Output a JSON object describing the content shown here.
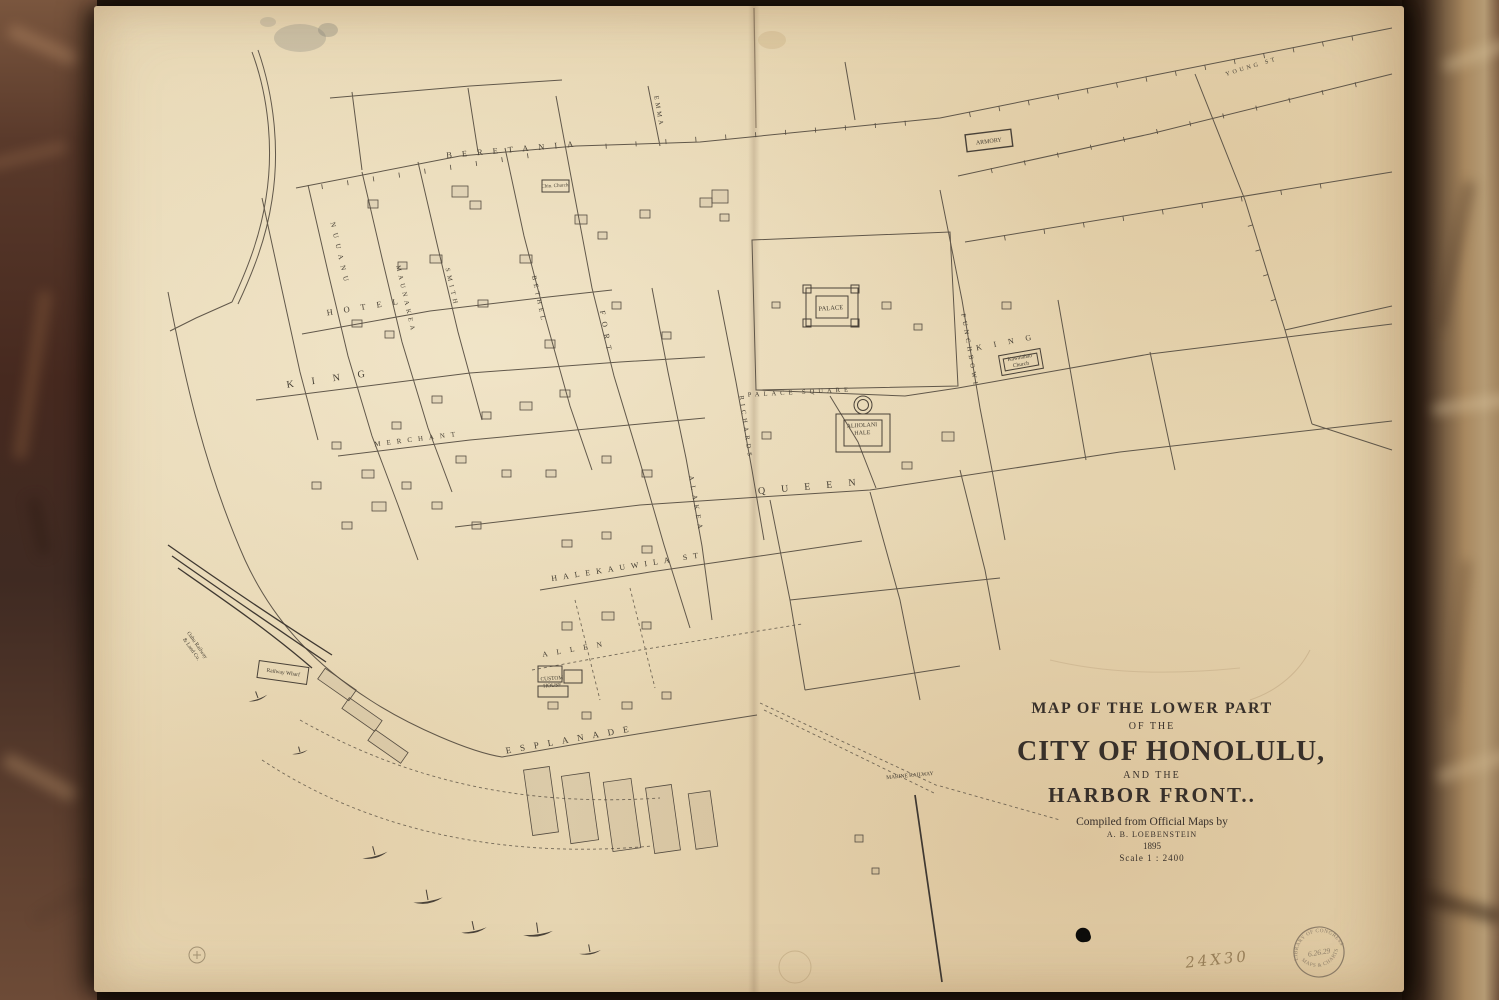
{
  "map": {
    "title_block": {
      "line1": "MAP OF THE LOWER PART",
      "line2": "OF THE",
      "line3": "CITY OF HONOLULU,",
      "line4": "AND THE",
      "line5": "HARBOR FRONT..",
      "credit_line": "Compiled from Official Maps by",
      "author": "A. B. LOEBENSTEIN",
      "year": "1895",
      "scale": "Scale    1 : 2400"
    },
    "stamp": {
      "arc_top": "LIBRARY OF CONGRESS",
      "center": "6.26.29",
      "arc_bottom": "MAPS & CHARTS"
    },
    "size_note": "24X30",
    "street_labels": [
      {
        "text": "BERETANIA",
        "x": 515,
        "y": 152,
        "rot": -5,
        "ls": 10,
        "fs": 8.5
      },
      {
        "text": "HOTEL",
        "x": 368,
        "y": 309,
        "rot": -9,
        "ls": 11,
        "fs": 8.5
      },
      {
        "text": "KING",
        "x": 335,
        "y": 381,
        "rot": -8,
        "ls": 18,
        "fs": 10
      },
      {
        "text": "MERCHANT",
        "x": 418,
        "y": 441,
        "rot": -7,
        "ls": 6,
        "fs": 7
      },
      {
        "text": "QUEEN",
        "x": 815,
        "y": 489,
        "rot": -5,
        "ls": 16,
        "fs": 10
      },
      {
        "text": "HALEKAUWILA ST",
        "x": 628,
        "y": 569,
        "rot": -9,
        "ls": 6,
        "fs": 8
      },
      {
        "text": "ALLEN",
        "x": 577,
        "y": 651,
        "rot": -10,
        "ls": 9,
        "fs": 7.5
      },
      {
        "text": "ESPLANADE",
        "x": 572,
        "y": 742,
        "rot": -10,
        "ls": 9,
        "fs": 9
      },
      {
        "text": "NUUANU",
        "x": 338,
        "y": 255,
        "rot": 77,
        "ls": 6,
        "fs": 7
      },
      {
        "text": "MAUNAKEA",
        "x": 404,
        "y": 300,
        "rot": 77,
        "ls": 4,
        "fs": 6.5
      },
      {
        "text": "SMITH",
        "x": 450,
        "y": 288,
        "rot": 77,
        "ls": 4,
        "fs": 6.5
      },
      {
        "text": "BETHEL",
        "x": 537,
        "y": 300,
        "rot": 78,
        "ls": 4,
        "fs": 6.5
      },
      {
        "text": "FORT",
        "x": 604,
        "y": 334,
        "rot": 80,
        "ls": 7,
        "fs": 7.5
      },
      {
        "text": "ALAKEA",
        "x": 694,
        "y": 505,
        "rot": 80,
        "ls": 5,
        "fs": 7
      },
      {
        "text": "RICHARDS",
        "x": 744,
        "y": 428,
        "rot": 82,
        "ls": 4,
        "fs": 6.5
      },
      {
        "text": "EMMA",
        "x": 657,
        "y": 112,
        "rot": 80,
        "ls": 3,
        "fs": 6.5
      },
      {
        "text": "PUNCHBOWL",
        "x": 968,
        "y": 352,
        "rot": 80,
        "ls": 4,
        "fs": 6.5
      },
      {
        "text": "PALACE   SQUARE",
        "x": 800,
        "y": 394,
        "rot": -3,
        "ls": 4,
        "fs": 6.5
      },
      {
        "text": "KING",
        "x": 1010,
        "y": 344,
        "rot": -11,
        "ls": 12,
        "fs": 8
      },
      {
        "text": "YOUNG ST",
        "x": 1252,
        "y": 68,
        "rot": -17,
        "ls": 3,
        "fs": 6
      }
    ],
    "building_labels": [
      {
        "lines": [
          "PALACE"
        ],
        "x": 831,
        "y": 310,
        "rot": -4,
        "fs": 6.5
      },
      {
        "lines": [
          "ALIIOLANI",
          "HALE"
        ],
        "x": 862,
        "y": 427,
        "rot": -3,
        "fs": 6
      },
      {
        "lines": [
          "ARMORY"
        ],
        "x": 989,
        "y": 143,
        "rot": -7,
        "fs": 6
      },
      {
        "lines": [
          "CUSTOM",
          "HOUSE"
        ],
        "x": 552,
        "y": 680,
        "rot": -4,
        "fs": 5.5
      },
      {
        "lines": [
          "Chin. Church"
        ],
        "x": 555,
        "y": 187,
        "rot": -3,
        "fs": 5
      },
      {
        "lines": [
          "Kawaiahao",
          "Church"
        ],
        "x": 1020,
        "y": 359,
        "rot": -10,
        "fs": 5.5
      },
      {
        "lines": [
          "MARINE RAILWAY"
        ],
        "x": 910,
        "y": 777,
        "rot": -5,
        "fs": 5.5
      },
      {
        "lines": [
          "Railway Wharf"
        ],
        "x": 283,
        "y": 674,
        "rot": 8,
        "fs": 5.5
      },
      {
        "lines": [
          "Oahu Railway",
          "& Land Co."
        ],
        "x": 196,
        "y": 646,
        "rot": 55,
        "fs": 5.5
      }
    ]
  }
}
